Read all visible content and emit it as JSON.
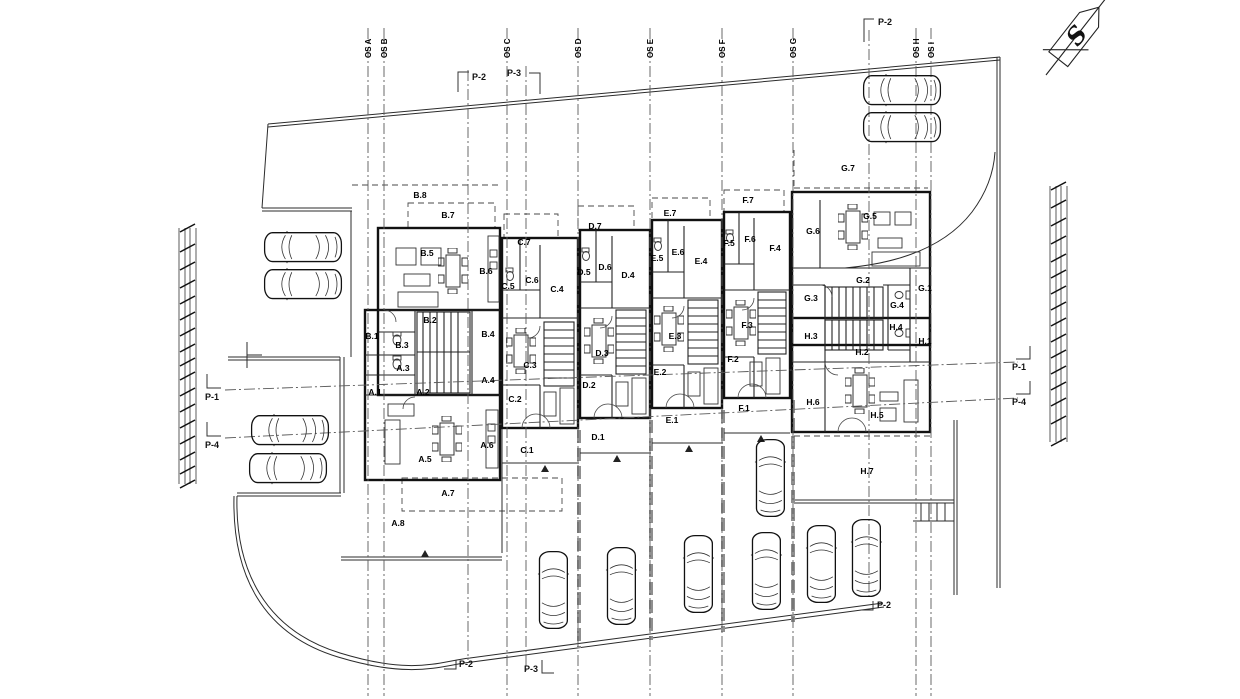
{
  "north_arrow": {
    "label": "S"
  },
  "grid_axes": [
    {
      "label": "OS A",
      "x": 368
    },
    {
      "label": "OS B",
      "x": 384
    },
    {
      "label": "OS C",
      "x": 507
    },
    {
      "label": "OS D",
      "x": 578
    },
    {
      "label": "OS E",
      "x": 650
    },
    {
      "label": "OS F",
      "x": 722
    },
    {
      "label": "OS G",
      "x": 793
    },
    {
      "label": "OS H",
      "x": 916
    },
    {
      "label": "OS I",
      "x": 931
    }
  ],
  "section_lines": [
    {
      "name": "P-2-left",
      "x1": 468,
      "y1": 70,
      "x2": 468,
      "y2": 660
    },
    {
      "name": "P-3",
      "x1": 526,
      "y1": 66,
      "x2": 526,
      "y2": 672
    },
    {
      "name": "P-2-right",
      "x1": 869,
      "y1": 30,
      "x2": 869,
      "y2": 600
    },
    {
      "name": "P-1",
      "x1": 225,
      "y1": 390,
      "x2": 1018,
      "y2": 362
    },
    {
      "name": "P-4",
      "x1": 225,
      "y1": 438,
      "x2": 1018,
      "y2": 398
    }
  ],
  "section_markers": [
    {
      "label": "P-2",
      "x": 472,
      "y": 80,
      "anchor": "start",
      "bracket": "458,92 458,72 469,72"
    },
    {
      "label": "P-3",
      "x": 521,
      "y": 76,
      "anchor": "end",
      "bracket": "540,94 540,73 529,73"
    },
    {
      "label": "P-2",
      "x": 878,
      "y": 25,
      "anchor": "start",
      "bracket": "864,42 864,19 874,19"
    },
    {
      "label": "P-1",
      "x": 205,
      "y": 400,
      "anchor": "start",
      "bracket": "207,374 207,388 221,388"
    },
    {
      "label": "P-4",
      "x": 205,
      "y": 448,
      "anchor": "start",
      "bracket": "207,422 207,436 221,436"
    },
    {
      "label": "P-1",
      "x": 1012,
      "y": 370,
      "anchor": "start",
      "bracket": "1030,346 1030,359 1016,359"
    },
    {
      "label": "P-4",
      "x": 1012,
      "y": 405,
      "anchor": "start",
      "bracket": "1030,381 1030,394 1016,394"
    },
    {
      "label": "P-2",
      "x": 877,
      "y": 608,
      "anchor": "start",
      "bracket": "861,610 873,610 873,601"
    },
    {
      "label": "P-3",
      "x": 538,
      "y": 672,
      "anchor": "end",
      "bracket": "542,660 542,673 554,673"
    },
    {
      "label": "P-2",
      "x": 459,
      "y": 667,
      "anchor": "start",
      "bracket": "444,669 456,669 456,660"
    }
  ],
  "room_labels": [
    {
      "text": "A.1",
      "x": 375,
      "y": 392
    },
    {
      "text": "A.2",
      "x": 423,
      "y": 392
    },
    {
      "text": "A.3",
      "x": 403,
      "y": 368
    },
    {
      "text": "A.4",
      "x": 488,
      "y": 380
    },
    {
      "text": "A.5",
      "x": 425,
      "y": 459
    },
    {
      "text": "A.6",
      "x": 487,
      "y": 445
    },
    {
      "text": "A.7",
      "x": 448,
      "y": 493
    },
    {
      "text": "A.8",
      "x": 398,
      "y": 523
    },
    {
      "text": "B.1",
      "x": 372,
      "y": 336
    },
    {
      "text": "B.2",
      "x": 430,
      "y": 320
    },
    {
      "text": "B.3",
      "x": 402,
      "y": 345
    },
    {
      "text": "B.4",
      "x": 488,
      "y": 334
    },
    {
      "text": "B.5",
      "x": 427,
      "y": 253
    },
    {
      "text": "B.6",
      "x": 486,
      "y": 271
    },
    {
      "text": "B.7",
      "x": 448,
      "y": 215
    },
    {
      "text": "B.8",
      "x": 420,
      "y": 195
    },
    {
      "text": "C.1",
      "x": 527,
      "y": 450
    },
    {
      "text": "C.2",
      "x": 515,
      "y": 399
    },
    {
      "text": "C.3",
      "x": 530,
      "y": 365
    },
    {
      "text": "C.4",
      "x": 557,
      "y": 289
    },
    {
      "text": "C.5",
      "x": 508,
      "y": 286
    },
    {
      "text": "C.6",
      "x": 532,
      "y": 280
    },
    {
      "text": "C.7",
      "x": 524,
      "y": 242
    },
    {
      "text": "D.1",
      "x": 598,
      "y": 437
    },
    {
      "text": "D.2",
      "x": 589,
      "y": 385
    },
    {
      "text": "D.3",
      "x": 602,
      "y": 353
    },
    {
      "text": "D.4",
      "x": 628,
      "y": 275
    },
    {
      "text": "D.5",
      "x": 584,
      "y": 272
    },
    {
      "text": "D.6",
      "x": 605,
      "y": 267
    },
    {
      "text": "D.7",
      "x": 595,
      "y": 226
    },
    {
      "text": "E.1",
      "x": 672,
      "y": 420
    },
    {
      "text": "E.2",
      "x": 660,
      "y": 372
    },
    {
      "text": "E.3",
      "x": 675,
      "y": 336
    },
    {
      "text": "E.4",
      "x": 701,
      "y": 261
    },
    {
      "text": "E.5",
      "x": 657,
      "y": 258
    },
    {
      "text": "E.6",
      "x": 678,
      "y": 252
    },
    {
      "text": "E.7",
      "x": 670,
      "y": 213
    },
    {
      "text": "F.1",
      "x": 744,
      "y": 408
    },
    {
      "text": "F.2",
      "x": 733,
      "y": 359
    },
    {
      "text": "F.3",
      "x": 747,
      "y": 325
    },
    {
      "text": "F.4",
      "x": 775,
      "y": 248
    },
    {
      "text": "F.5",
      "x": 729,
      "y": 243
    },
    {
      "text": "F.6",
      "x": 750,
      "y": 239
    },
    {
      "text": "F.7",
      "x": 748,
      "y": 200
    },
    {
      "text": "G.1",
      "x": 925,
      "y": 288
    },
    {
      "text": "G.2",
      "x": 863,
      "y": 280
    },
    {
      "text": "G.3",
      "x": 811,
      "y": 298
    },
    {
      "text": "G.4",
      "x": 897,
      "y": 305
    },
    {
      "text": "G.5",
      "x": 870,
      "y": 216
    },
    {
      "text": "G.6",
      "x": 813,
      "y": 231
    },
    {
      "text": "G.7",
      "x": 848,
      "y": 168
    },
    {
      "text": "H.1",
      "x": 925,
      "y": 341
    },
    {
      "text": "H.2",
      "x": 862,
      "y": 352
    },
    {
      "text": "H.3",
      "x": 811,
      "y": 336
    },
    {
      "text": "H.4",
      "x": 896,
      "y": 327
    },
    {
      "text": "H.5",
      "x": 877,
      "y": 415
    },
    {
      "text": "H.6",
      "x": 813,
      "y": 402
    },
    {
      "text": "H.7",
      "x": 867,
      "y": 471
    }
  ],
  "cars": [
    {
      "x": 263,
      "y": 231,
      "o": "h"
    },
    {
      "x": 263,
      "y": 268,
      "o": "h"
    },
    {
      "x": 250,
      "y": 414,
      "o": "h"
    },
    {
      "x": 248,
      "y": 452,
      "o": "h"
    },
    {
      "x": 862,
      "y": 74,
      "o": "h"
    },
    {
      "x": 862,
      "y": 111,
      "o": "h"
    },
    {
      "x": 755,
      "y": 438,
      "o": "v"
    },
    {
      "x": 538,
      "y": 550,
      "o": "v"
    },
    {
      "x": 606,
      "y": 546,
      "o": "v"
    },
    {
      "x": 683,
      "y": 534,
      "o": "v"
    },
    {
      "x": 751,
      "y": 531,
      "o": "v"
    },
    {
      "x": 806,
      "y": 524,
      "o": "v"
    },
    {
      "x": 851,
      "y": 518,
      "o": "v"
    }
  ],
  "dim_strips": [
    {
      "x": [
        179,
        185,
        190,
        196
      ],
      "y1": 228,
      "y2": 484,
      "tx": 185,
      "tick_ys": [
        228,
        248,
        266,
        284,
        300,
        316,
        332,
        348,
        362,
        376,
        392,
        408,
        424,
        440,
        456,
        470,
        484
      ]
    },
    {
      "x": [
        1050,
        1056,
        1061,
        1067
      ],
      "y1": 186,
      "y2": 442,
      "tx": 1056,
      "tick_ys": [
        186,
        204,
        222,
        240,
        258,
        274,
        290,
        306,
        322,
        338,
        354,
        370,
        386,
        402,
        420,
        442
      ]
    }
  ]
}
